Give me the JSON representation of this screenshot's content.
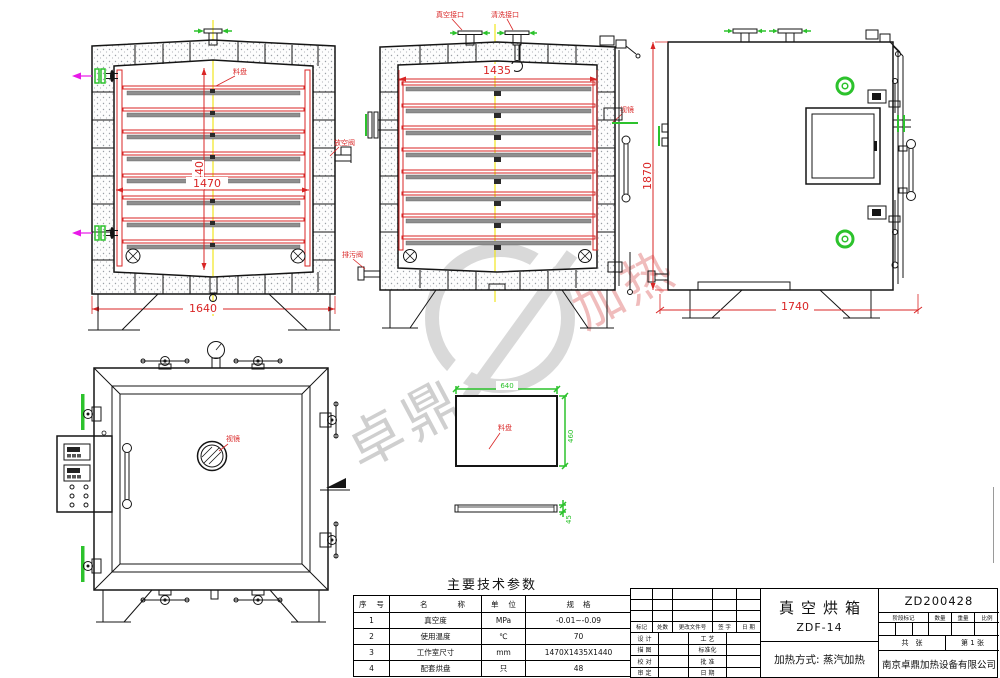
{
  "drawing": {
    "labels": {
      "tray": "料盘",
      "vent_valve": "放空阀",
      "drain_valve": "排污阀",
      "vacuum_port": "真空接口",
      "wash_port": "清洗接口",
      "sight_glass": "视镜"
    },
    "dims": {
      "front_inner_height": "1440",
      "front_inner_width": "1470",
      "front_overall_width": "1640",
      "side_inner_width": "1435",
      "elev_height": "1870",
      "elev_width": "1740",
      "tray_length": "640",
      "tray_width": "460",
      "tray_height": "45"
    }
  },
  "params_table": {
    "title": "主要技术参数",
    "headers": [
      "序 号",
      "名称",
      "单 位",
      "规格"
    ],
    "rows": [
      {
        "no": "1",
        "name": "真空度",
        "unit": "MPa",
        "spec": "-0.01~-0.09"
      },
      {
        "no": "2",
        "name": "使用温度",
        "unit": "℃",
        "spec": "70"
      },
      {
        "no": "3",
        "name": "工作室尺寸",
        "unit": "mm",
        "spec": "1470X1435X1440"
      },
      {
        "no": "4",
        "name": "配套烘盘",
        "unit": "只",
        "spec": "48"
      }
    ]
  },
  "title_block": {
    "product_name": "真空烘箱",
    "model": "ZDF-14",
    "drawing_no": "ZD200428",
    "heating_method": "加热方式: 蒸汽加热",
    "company": "南京卓鼎加热设备有限公司",
    "rev_headers": [
      "标记",
      "处数",
      "更改文件号",
      "签 字",
      "日 期"
    ],
    "sig_left": [
      "设 计",
      "描 图",
      "校 对",
      "审 定"
    ],
    "sig_right": [
      "工 艺",
      "标准化",
      "批 准",
      "日 期"
    ],
    "stage_headers": [
      "阶段标记",
      "数量",
      "重量",
      "比例"
    ],
    "sheet_total": "共　张",
    "sheet_no": "第 1 张"
  },
  "watermark": {
    "left_text": "卓鼎",
    "right_text": "加热"
  },
  "colors": {
    "line_red": "#d92525",
    "line_green": "#2cc22c",
    "line_magenta": "#e818e8",
    "centerline_yellow": "#f0e40a",
    "watermark_gray": "#d7d7d7",
    "watermark_pink": "#f0bcbc"
  }
}
